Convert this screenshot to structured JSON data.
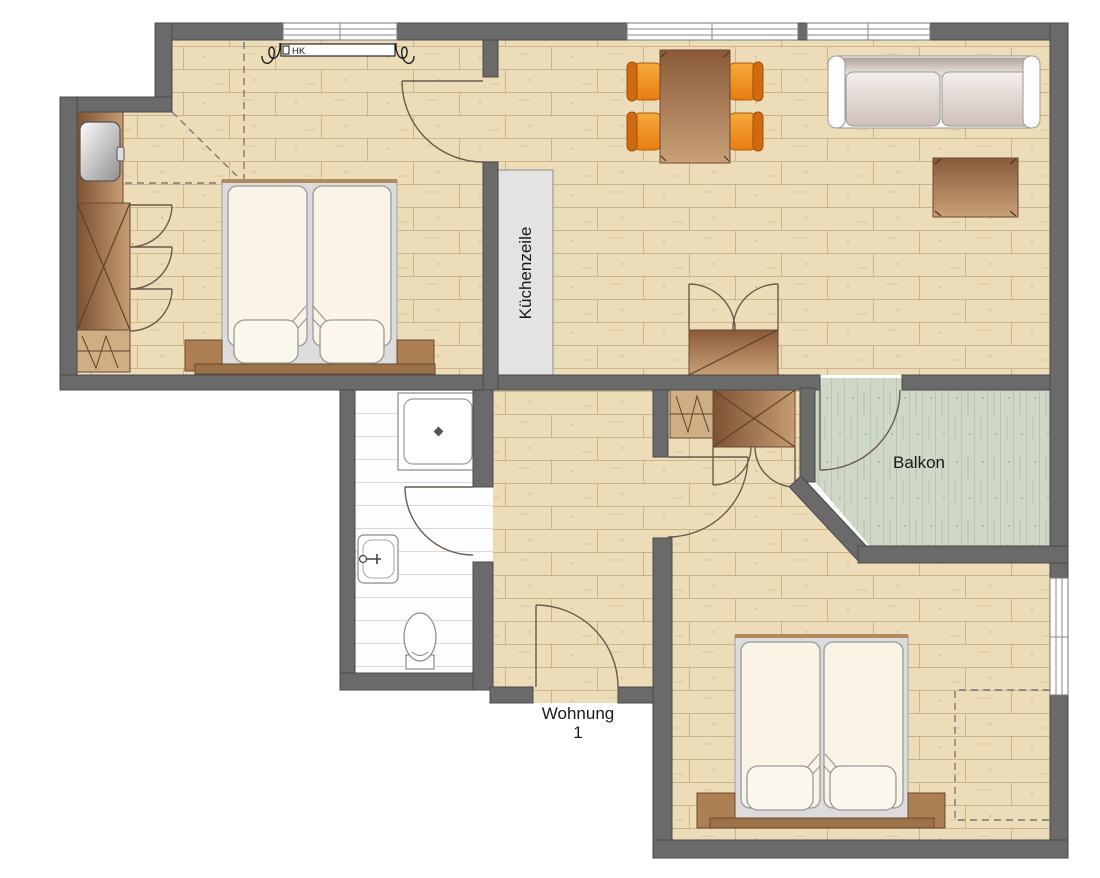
{
  "title": "Apartment floor plan",
  "labels": {
    "kitchen_unit": "Küchenzeile",
    "balcony": "Balkon",
    "apartment_line1": "Wohnung",
    "apartment_line2": "1",
    "radiator": "HK"
  },
  "colors": {
    "wall": "#6a6a6a",
    "wall_outline": "#4a4a4a",
    "wood_floor": "#eddcb8",
    "wood_plank_line": "#cdb489",
    "balcony_floor": "#cfd7c7",
    "bathroom_floor": "#fdfdfd",
    "furniture_brown_dark": "#8f613e",
    "furniture_brown_light": "#c79f76",
    "nightstand_brown": "#ab7f52",
    "headboard_brown": "#9c7248",
    "chair_orange": "#ef8a1c",
    "chair_orange_dark": "#d06a10",
    "mattress_cream": "#f9f4e6",
    "bed_frame_gray": "#dcdcdc",
    "kitchen_unit_gray": "#e3e3e3",
    "door_line": "#6b5b4b",
    "text": "#1a1a1a"
  },
  "furniture": {
    "bedroom_1": [
      "double-bed",
      "nightstands",
      "wardrobe",
      "dresser-with-mirror",
      "shelf"
    ],
    "living_room": [
      "dining-table",
      "four-chairs",
      "sofa",
      "coffee-table",
      "cabinet",
      "kitchen-unit",
      "radiator"
    ],
    "hallway": [
      "wardrobe",
      "shelf"
    ],
    "bathroom": [
      "shower",
      "sink",
      "toilet"
    ],
    "bedroom_2": [
      "double-bed",
      "nightstands"
    ]
  }
}
